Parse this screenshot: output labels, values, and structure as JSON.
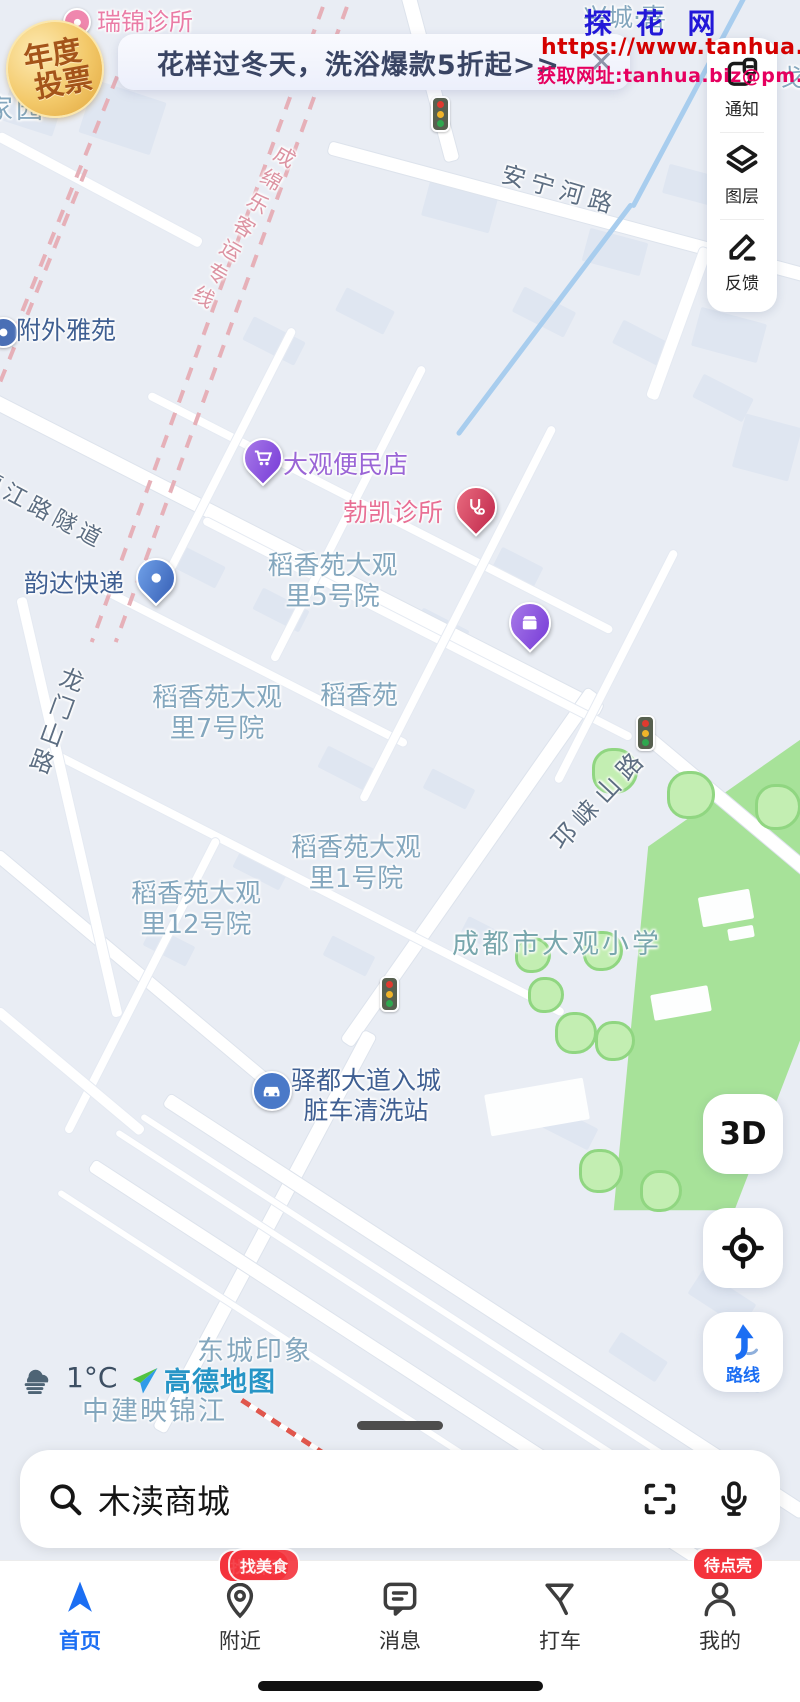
{
  "watermark": {
    "title": "探 花 网",
    "url": "https://www.tanhua.biz",
    "contact": "获取网址:tanhua.biz@pm.me"
  },
  "promo_badge": {
    "line1": "年度",
    "line2": "投票"
  },
  "banner": {
    "text": "花样过冬天，洗浴爆款5折起>>",
    "close_icon": "✕"
  },
  "side_panel": [
    {
      "label": "通知"
    },
    {
      "label": "图层"
    },
    {
      "label": "反馈"
    }
  ],
  "map_controls": {
    "three_d": "3D",
    "route_label": "路线"
  },
  "weather": {
    "temp": "1°C"
  },
  "map_logo": "高德地图",
  "search": {
    "query": "木渎商城"
  },
  "nav": [
    {
      "label": "首页",
      "active": true
    },
    {
      "label": "附近",
      "badge": "找休闲",
      "badge_prev": "找美食"
    },
    {
      "label": "消息"
    },
    {
      "label": "打车"
    },
    {
      "label": "我的",
      "badge": "待点亮"
    }
  ],
  "colors": {
    "accent_blue": "#1b6ef3",
    "badge_red": "#f4333c",
    "green_area": "#a7e299"
  },
  "map": {
    "labels": [
      {
        "t": "瑞锦诊所",
        "x": 97,
        "y": 8,
        "c": "pink",
        "s": 24
      },
      {
        "t": "兴城·喜",
        "x": 583,
        "y": 3,
        "c": "area",
        "s": 25
      },
      {
        "t": "戈",
        "x": 780,
        "y": 64,
        "c": "area",
        "s": 24
      },
      {
        "t": "家园",
        "x": -14,
        "y": 94,
        "c": "area",
        "s": 27,
        "ls": 3
      },
      {
        "t": "安宁河路",
        "x": 506,
        "y": 160,
        "c": "roadl",
        "s": 24,
        "ls": 6,
        "rot": 16
      },
      {
        "t": "成绵乐客运专线",
        "x": 278,
        "y": 140,
        "c": "raill",
        "s": 21,
        "ls": 6,
        "rot": 30,
        "vert": 1
      },
      {
        "t": "附外雅苑",
        "x": 16,
        "y": 316,
        "c": "navy",
        "s": 25
      },
      {
        "t": "渠江路隧道",
        "x": -14,
        "y": 466,
        "c": "roadl",
        "s": 23,
        "ls": 5,
        "rot": 28
      },
      {
        "t": "大观便民店",
        "x": 283,
        "y": 450,
        "c": "purple",
        "s": 25
      },
      {
        "t": "勃凯诊所",
        "x": 343,
        "y": 498,
        "c": "pinkred",
        "s": 25
      },
      {
        "t": "韵达快递",
        "x": 24,
        "y": 569,
        "c": "navy",
        "s": 25
      },
      {
        "t": "稻香苑大观\n里5号院",
        "x": 240,
        "y": 551,
        "c": "area center",
        "s": 26,
        "w": 185
      },
      {
        "t": "稻香苑大观\n里7号院",
        "x": 132,
        "y": 683,
        "c": "area center",
        "s": 26,
        "w": 170
      },
      {
        "t": "稻香苑",
        "x": 320,
        "y": 681,
        "c": "area",
        "s": 26
      },
      {
        "t": "龙门山路",
        "x": 60,
        "y": 662,
        "c": "roadl",
        "s": 24,
        "ls": 5,
        "rot": 20,
        "vert": 1
      },
      {
        "t": "邛崃山路",
        "x": 545,
        "y": 836,
        "c": "roadl",
        "s": 25,
        "ls": 7,
        "rot": -47
      },
      {
        "t": "稻香苑大观\n里1号院",
        "x": 276,
        "y": 833,
        "c": "area center",
        "s": 26,
        "w": 160
      },
      {
        "t": "稻香苑大观\n里12号院",
        "x": 112,
        "y": 879,
        "c": "area center",
        "s": 26,
        "w": 168
      },
      {
        "t": "成都市大观小学",
        "x": 452,
        "y": 929,
        "c": "school",
        "s": 27,
        "ls": 3
      },
      {
        "t": "驿都大道入城\n脏车清洗站",
        "x": 285,
        "y": 1066,
        "c": "navy center",
        "s": 25,
        "w": 162
      },
      {
        "t": "东城印象",
        "x": 197,
        "y": 1336,
        "c": "area",
        "s": 27,
        "ls": 2
      },
      {
        "t": "中建映锦江",
        "x": 82,
        "y": 1396,
        "c": "area",
        "s": 27,
        "ls": 2
      }
    ],
    "pins": [
      {
        "k": "circle",
        "c": "#ef87ae",
        "x": 75,
        "y": 20,
        "d": 24,
        "g": "dot",
        "n": "clinic-pin-ruijin"
      },
      {
        "k": "circle",
        "c": "#4a6fb5",
        "x": 1,
        "y": 330,
        "d": 27,
        "g": "dot",
        "n": "residence-pin-fuwai"
      },
      {
        "k": "tear",
        "c": "purple",
        "x": 261,
        "y": 482,
        "s": 36,
        "g": "cart",
        "n": "store-pin-daguan"
      },
      {
        "k": "tear",
        "c": "red",
        "x": 474,
        "y": 532,
        "s": 38,
        "g": "med",
        "n": "clinic-pin-bokai"
      },
      {
        "k": "tear",
        "c": "blue",
        "x": 154,
        "y": 602,
        "s": 36,
        "g": "dot",
        "n": "express-pin-yunda"
      },
      {
        "k": "tear",
        "c": "purple",
        "x": 528,
        "y": 648,
        "s": 38,
        "g": "box",
        "n": "shop-pin-jiasheng"
      },
      {
        "k": "circle",
        "c": "#4a79c8",
        "x": 270,
        "y": 1089,
        "d": 36,
        "g": "car",
        "n": "carwash-pin-yidu"
      }
    ],
    "traffic_lights": [
      [
        440,
        114
      ],
      [
        645,
        733
      ],
      [
        389,
        994
      ]
    ]
  }
}
